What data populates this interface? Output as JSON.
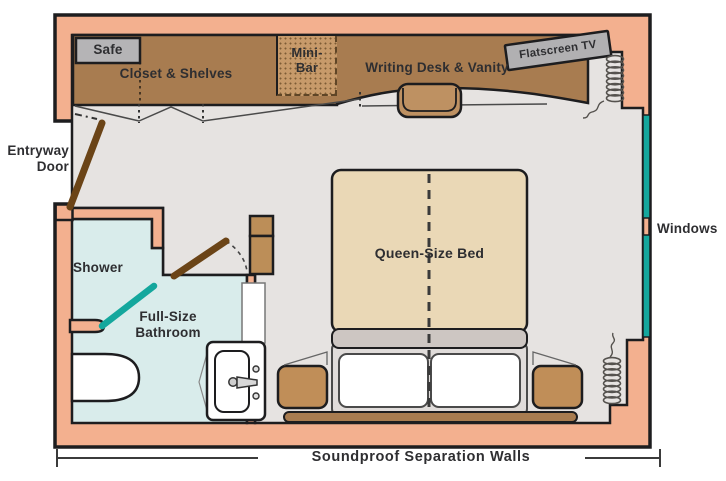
{
  "floorplan": {
    "furniture": {
      "safe": "Safe",
      "closet": "Closet & Shelves",
      "minibar": {
        "line1": "Mini-",
        "line2": "Bar"
      },
      "desk": "Writing Desk & Vanity",
      "tv": "Flatscreen TV",
      "bed": "Queen-Size Bed"
    },
    "rooms": {
      "shower": "Shower",
      "bathroom": {
        "line1": "Full-Size",
        "line2": "Bathroom"
      }
    },
    "annotations": {
      "entry": {
        "line1": "Entryway",
        "line2": "Door"
      },
      "windows": "Windows",
      "soundproof": "Soundproof Separation Walls"
    },
    "colors": {
      "wall_pink": "#F3B08F",
      "outline": "#1D1D1F",
      "floor_gray": "#E6E3E1",
      "bathroom_blue": "#D9ECEB",
      "wood_brown": "#A87C50",
      "minibar_brown": "#C79A6A",
      "nightstand_brown": "#C08E58",
      "door_brown": "#6B4417",
      "window_teal": "#14A79D",
      "fixture_gray": "#B5B4B6",
      "bed_tan": "#EAD8B6",
      "bed_gray_band": "#CDC6C2",
      "text": "#2E2E31"
    }
  }
}
